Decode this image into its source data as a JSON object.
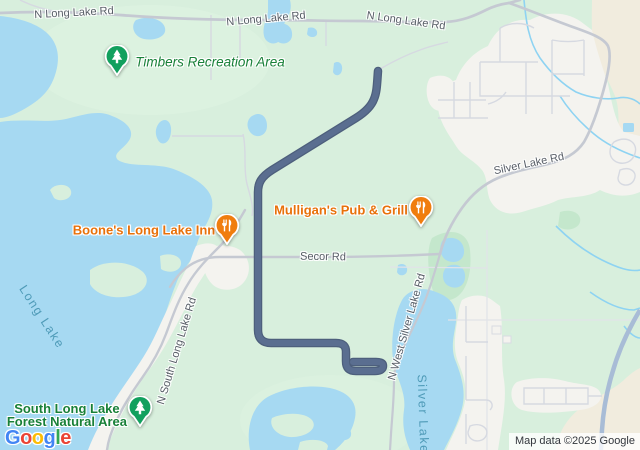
{
  "provider_logo": {
    "letters": [
      {
        "ch": "G",
        "color": "#4285F4"
      },
      {
        "ch": "o",
        "color": "#EA4335"
      },
      {
        "ch": "o",
        "color": "#FBBC05"
      },
      {
        "ch": "g",
        "color": "#4285F4"
      },
      {
        "ch": "l",
        "color": "#34A853"
      },
      {
        "ch": "e",
        "color": "#EA4335"
      }
    ]
  },
  "attribution": "Map data ©2025 Google",
  "roads": {
    "n_long_lake_rd": "N Long Lake Rd",
    "silver_lake_rd": "Silver Lake Rd",
    "secor_rd": "Secor Rd",
    "n_south_long_lake_rd": "N South Long Lake Rd",
    "n_west_silver_lake_rd": "N West Silver Lake Rd"
  },
  "water_labels": {
    "long_lake": "Long Lake",
    "silver_lake": "Silver Lake"
  },
  "pois": {
    "timbers": {
      "label": "Timbers Recreation Area",
      "type": "park"
    },
    "boones": {
      "label": "Boone's Long Lake Inn",
      "type": "restaurant"
    },
    "mulligans": {
      "label": "Mulligan's Pub & Grill",
      "type": "restaurant"
    },
    "south_forest": {
      "line1": "South Long Lake",
      "line2": "Forest Natural Area",
      "type": "park"
    }
  },
  "colors": {
    "route": "#5a6e90",
    "route_casing": "#4d5f7c",
    "water": "#a6d9f2",
    "park_label": "#188038",
    "food_label": "#e8710a",
    "road_label": "#575d66",
    "water_label": "#4f9bb8",
    "restaurant_pin": "#f07d0e",
    "park_pin": "#12a05e"
  }
}
